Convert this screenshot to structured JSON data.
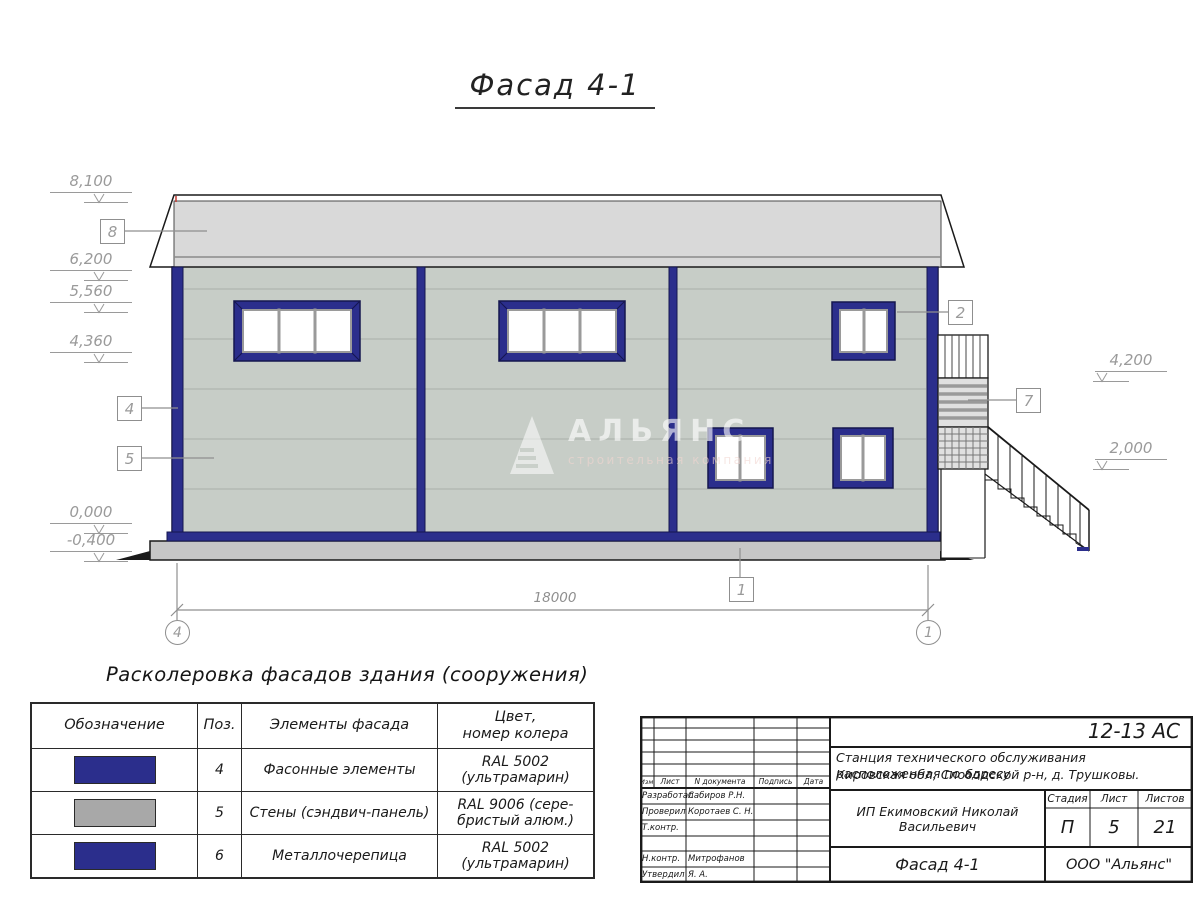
{
  "title": "Фасад 4-1",
  "facade": {
    "elevations_left": [
      "8,100",
      "6,200",
      "5,560",
      "4,360",
      "0,000",
      "-0,400"
    ],
    "elevations_right": [
      "4,200",
      "2,000"
    ],
    "callouts": {
      "roof": "8",
      "corner_trim": "4",
      "wall": "5",
      "window": "2",
      "stair": "7",
      "plinth": "1"
    },
    "axes": {
      "left": "4",
      "right": "1"
    },
    "dimension_length": "18000",
    "watermark": {
      "brand": "АЛЬЯНС",
      "tagline": "строительная компания"
    }
  },
  "legend": {
    "heading": "Расколеровка фасадов здания (сооружения)",
    "columns": {
      "designation": "Обозначение",
      "pos": "Поз.",
      "element": "Элементы фасада",
      "color": "Цвет,\nномер колера"
    },
    "rows": [
      {
        "swatch": "#2b2e8c",
        "pos": "4",
        "element": "Фасонные элементы",
        "color": "RAL 5002\n(ультрамарин)"
      },
      {
        "swatch": "#a8a8a8",
        "pos": "5",
        "element": "Стены (сэндвич-панель)",
        "color": "RAL 9006 (сере-\nбристый алюм.)"
      },
      {
        "swatch": "#2b2e8c",
        "pos": "6",
        "element": "Металлочерепица",
        "color": "RAL 5002\n(ультрамарин)"
      }
    ]
  },
  "stamp": {
    "code": "12-13 АС",
    "description": [
      "Станция технического обслуживания расположенная по адресу",
      "Кировская обл, Слободской р-н, д. Трушковы."
    ],
    "client": "ИП Екимовский Николай Васильевич",
    "drawing_name": "Фасад 4-1",
    "company": "ООО \"Альянс\"",
    "rev_header": [
      "Изм.",
      "Лист",
      "N документа",
      "Подпись",
      "Дата"
    ],
    "cols": {
      "stage_label": "Стадия",
      "sheet_label": "Лист",
      "sheets_label": "Листов"
    },
    "stage": "П",
    "sheet": "5",
    "total_sheets": "21",
    "roles": [
      {
        "label": "Разработал",
        "name": "Сабиров Р.Н."
      },
      {
        "label": "Проверил",
        "name": "Коротаев С. Н."
      },
      {
        "label": "Т.контр.",
        "name": ""
      },
      {
        "label": "Н.контр.",
        "name": "Митрофанов Я. А."
      },
      {
        "label": "Утвердил",
        "name": ""
      }
    ]
  }
}
